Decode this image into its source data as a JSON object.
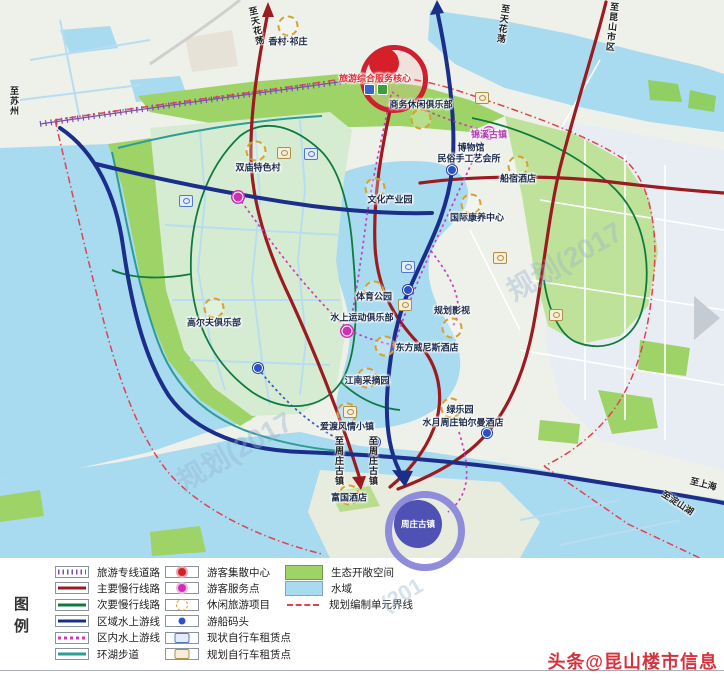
{
  "colors": {
    "water": "#a8daf0",
    "eco_green": "#9ed467",
    "main_road_red": "#9b1b20",
    "regional_water_navy": "#1b2f8a",
    "secondary_green": "#0f7a40",
    "inner_water_magenta": "#c83bbc",
    "lake_trail_teal": "#2e9c96",
    "rail_purple": "#7b4fb0",
    "boundary_red": "#e2414e",
    "credit_red": "#d5343f"
  },
  "legend": {
    "title": "图例",
    "col1": [
      {
        "label": "旅游专线道路",
        "type": "rail"
      },
      {
        "label": "主要慢行线路",
        "type": "main-slow"
      },
      {
        "label": "次要慢行线路",
        "type": "secondary-slow"
      },
      {
        "label": "区域水上游线",
        "type": "regional-water"
      },
      {
        "label": "区内水上游线",
        "type": "inner-water"
      },
      {
        "label": "环湖步道",
        "type": "lake-trail"
      }
    ],
    "col2": [
      {
        "label": "游客集散中心",
        "type": "visitor-center"
      },
      {
        "label": "游客服务点",
        "type": "service-point"
      },
      {
        "label": "休闲旅游项目",
        "type": "leisure-project"
      },
      {
        "label": "游船码头",
        "type": "boat-dock"
      },
      {
        "label": "现状自行车租赁点",
        "type": "bike-existing"
      },
      {
        "label": "规划自行车租赁点",
        "type": "bike-planned"
      }
    ],
    "col3": [
      {
        "label": "生态开敞空间",
        "type": "eco-space"
      },
      {
        "label": "水域",
        "type": "water-area"
      },
      {
        "label": "规划编制单元界线",
        "type": "boundary"
      }
    ]
  },
  "map": {
    "core": {
      "label": "旅游综合服务核心",
      "x": 375,
      "y": 78
    },
    "zhouzhuang": {
      "label": "周庄古镇",
      "x": 418,
      "y": 524
    },
    "pois": [
      {
        "label": "香村·祁庄",
        "x": 288,
        "y": 41,
        "icon": "leisure",
        "ix": 288,
        "iy": 26
      },
      {
        "label": "商务休闲俱乐部",
        "x": 421,
        "y": 104,
        "icon": "leisure",
        "ix": 421,
        "iy": 119
      },
      {
        "label": "双庙特色村",
        "x": 258,
        "y": 167,
        "icon": "leisure",
        "ix": 256,
        "iy": 151
      },
      {
        "label": "锦溪古镇",
        "x": 489,
        "y": 134,
        "cls": "magenta",
        "icon": "service",
        "ix": 489,
        "iy": 133
      },
      {
        "label": "博物馆",
        "x": 471,
        "y": 147
      },
      {
        "label": "民俗手工艺会所",
        "x": 469,
        "y": 158
      },
      {
        "label": "文化产业园",
        "x": 390,
        "y": 199,
        "icon": "leisure",
        "ix": 375,
        "iy": 188
      },
      {
        "label": "船宿酒店",
        "x": 518,
        "y": 178,
        "icon": "leisure",
        "ix": 518,
        "iy": 166
      },
      {
        "label": "国际康养中心",
        "x": 477,
        "y": 217,
        "icon": "leisure",
        "ix": 471,
        "iy": 204
      },
      {
        "label": "高尔夫俱乐部",
        "x": 214,
        "y": 322,
        "icon": "leisure",
        "ix": 214,
        "iy": 308
      },
      {
        "label": "体育公园",
        "x": 374,
        "y": 296,
        "icon": "leisure",
        "ix": 374,
        "iy": 291
      },
      {
        "label": "水上运动俱乐部",
        "x": 362,
        "y": 317
      },
      {
        "label": "规划影视",
        "x": 452,
        "y": 310,
        "icon": "leisure",
        "ix": 452,
        "iy": 328
      },
      {
        "label": "东方威尼斯酒店",
        "x": 427,
        "y": 347,
        "icon": "leisure",
        "ix": 385,
        "iy": 346
      },
      {
        "label": "江南采摘园",
        "x": 367,
        "y": 380,
        "icon": "leisure",
        "ix": 367,
        "iy": 378
      },
      {
        "label": "绿乐园",
        "x": 460,
        "y": 409,
        "icon": "leisure",
        "ix": 451,
        "iy": 408
      },
      {
        "label": "水月周庄铂尔曼酒店",
        "x": 463,
        "y": 422
      },
      {
        "label": "爱渡风情小镇",
        "x": 347,
        "y": 426,
        "icon": "leisure",
        "ix": 347,
        "iy": 413
      },
      {
        "label": "富国酒店",
        "x": 349,
        "y": 497,
        "icon": "leisure",
        "ix": 349,
        "iy": 495
      }
    ],
    "extra_icons": [
      {
        "type": "service",
        "x": 347,
        "y": 331
      },
      {
        "type": "service",
        "x": 238,
        "y": 197
      },
      {
        "type": "dock",
        "x": 258,
        "y": 368
      },
      {
        "type": "dock",
        "x": 452,
        "y": 170
      },
      {
        "type": "dock",
        "x": 408,
        "y": 290
      },
      {
        "type": "dock",
        "x": 487,
        "y": 433
      },
      {
        "type": "dock",
        "x": 375,
        "y": 442
      },
      {
        "type": "bike-existing",
        "x": 311,
        "y": 154
      },
      {
        "type": "bike-existing",
        "x": 186,
        "y": 201
      },
      {
        "type": "bike-existing",
        "x": 408,
        "y": 267
      },
      {
        "type": "bike-planned",
        "x": 284,
        "y": 153
      },
      {
        "type": "bike-planned",
        "x": 482,
        "y": 98
      },
      {
        "type": "bike-planned",
        "x": 405,
        "y": 305
      },
      {
        "type": "bike-planned",
        "x": 556,
        "y": 315
      },
      {
        "type": "bike-planned",
        "x": 350,
        "y": 412
      },
      {
        "type": "bike-planned",
        "x": 500,
        "y": 258
      }
    ],
    "route_labels": [
      {
        "label": "至苏州",
        "x": 8,
        "y": 86,
        "v": 1,
        "rot": 0
      },
      {
        "label": "至天花荡",
        "x": 250,
        "y": 6,
        "v": 1,
        "rot": -12
      },
      {
        "label": "至天花荡",
        "x": 497,
        "y": 4,
        "v": 1,
        "rot": 8
      },
      {
        "label": "至昆山市区",
        "x": 606,
        "y": 2,
        "v": 1,
        "rot": 6
      },
      {
        "label": "至周庄古镇",
        "x": 333,
        "y": 436,
        "v": 1,
        "rot": 0
      },
      {
        "label": "至周庄古镇",
        "x": 367,
        "y": 436,
        "v": 1,
        "rot": 0
      },
      {
        "label": "至上海",
        "x": 690,
        "y": 477,
        "v": 0,
        "rot": 14
      },
      {
        "label": "至淀山湖",
        "x": 660,
        "y": 496,
        "v": 0,
        "rot": 33
      }
    ],
    "watermark_fragments": [
      {
        "text": "规划(2017",
        "x": 170,
        "y": 430,
        "rot": -30,
        "size": 28
      },
      {
        "text": "规划(2017",
        "x": 500,
        "y": 240,
        "rot": -30,
        "size": 28
      },
      {
        "text": "(201",
        "x": 380,
        "y": 582,
        "rot": -30,
        "size": 22
      }
    ]
  },
  "credit": "头条@昆山楼市信息"
}
